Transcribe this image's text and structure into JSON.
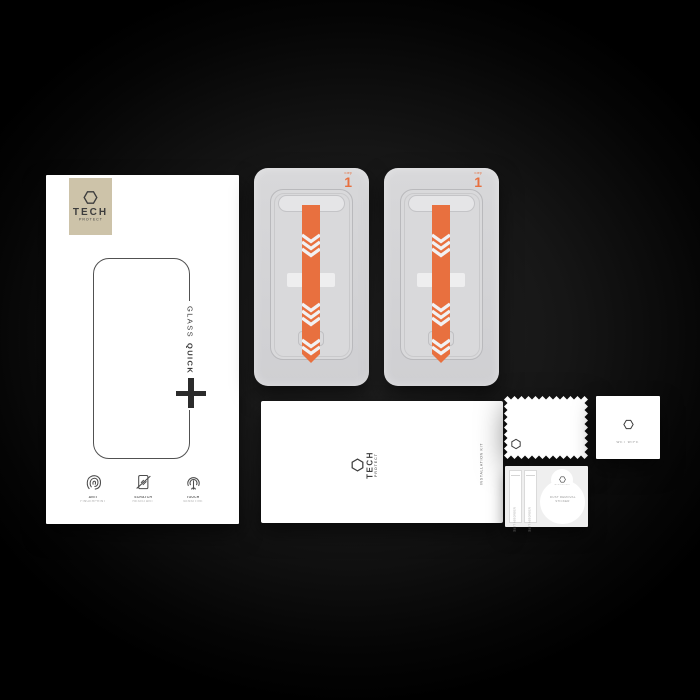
{
  "brand": {
    "line1": "TECH",
    "line2": "PROTECT",
    "full": "TECH PROTECT"
  },
  "box": {
    "glass_label": {
      "regular": "GLASS",
      "bold": "QUICK SET"
    },
    "features": [
      {
        "icon": "fingerprint-icon",
        "line1": "ANTI",
        "line2": "FINGERPRINT"
      },
      {
        "icon": "scratch-icon",
        "line1": "SCRATCH",
        "line2": "RESISTANT"
      },
      {
        "icon": "touch-icon",
        "line1": "TOUCH",
        "line2": "SENSITIVE"
      }
    ]
  },
  "tray": {
    "step_label": "Step",
    "step_number": "1"
  },
  "envelope": {
    "vertical_label": "INSTALLATION KIT"
  },
  "items": {
    "wet_wipe": {
      "label": "WET WIPE"
    },
    "dust_strip": {
      "label": "DUST ABSORBER"
    },
    "dust_sticker": {
      "line1": "DUST REMOVAL",
      "line2": "STICKER"
    }
  },
  "colors": {
    "accent_orange": "#e8703f",
    "logo_plate_beige": "#cdc3a9",
    "tray_gray": "#d5d5d7",
    "background_black": "#000000",
    "chevron_white": "#f1f1f3"
  }
}
